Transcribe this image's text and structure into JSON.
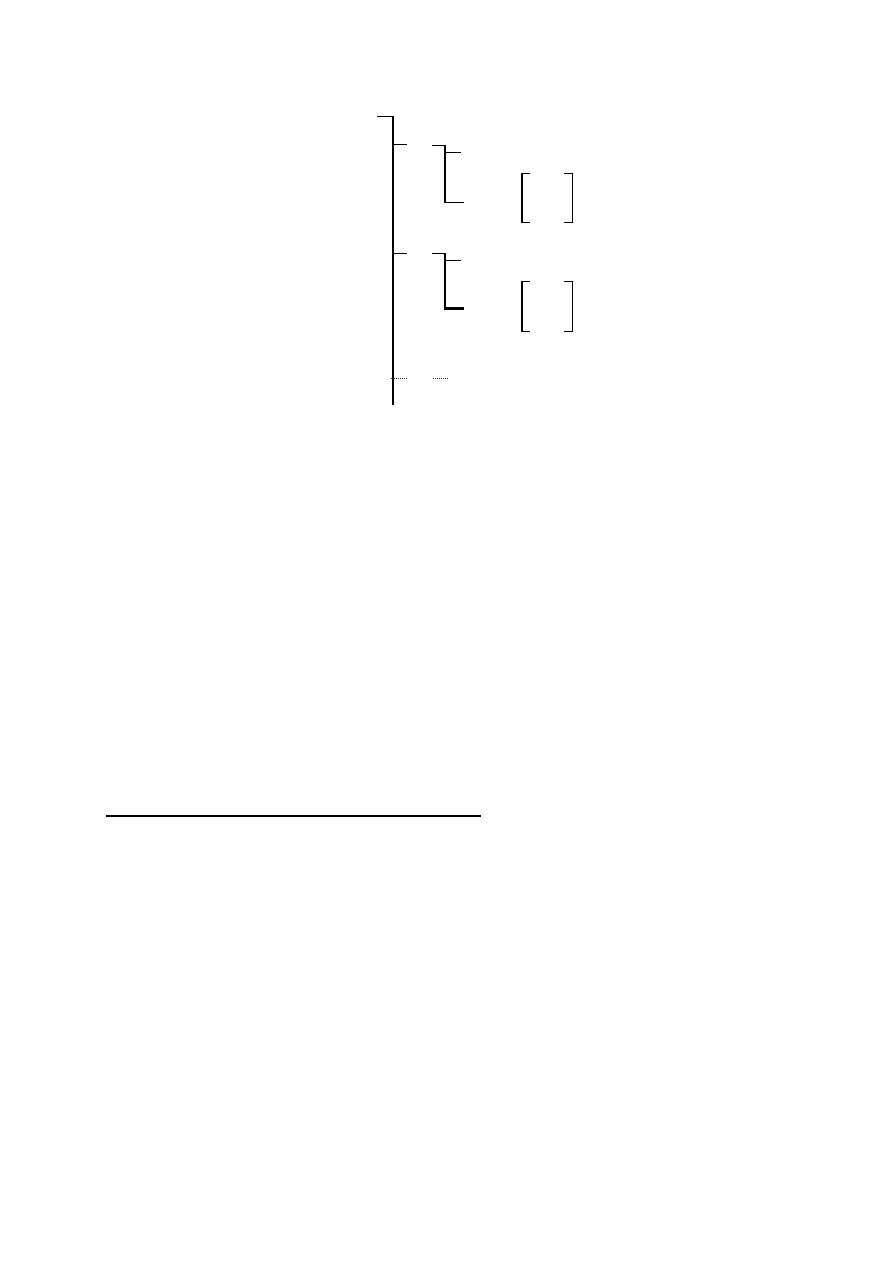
{
  "page": {
    "background": "#ffffff",
    "ink_color": "#000000",
    "dotted_color": "#333333"
  },
  "figure": {
    "segments": [
      {
        "name": "tree-root-top-bar",
        "group": "tree",
        "x": 377,
        "y": 116,
        "w": 16,
        "h": 1,
        "style": "solid"
      },
      {
        "name": "tree-trunk-vertical",
        "group": "tree",
        "x": 392,
        "y": 116,
        "w": 1.5,
        "h": 289,
        "style": "solid"
      },
      {
        "name": "tree-branch1-tick",
        "group": "tree",
        "x": 392,
        "y": 144,
        "w": 15,
        "h": 1,
        "style": "solid"
      },
      {
        "name": "tree-branch2-tick",
        "group": "tree",
        "x": 392,
        "y": 253,
        "w": 15,
        "h": 1,
        "style": "solid"
      },
      {
        "name": "tree-branch3-dotted-tick",
        "group": "tree",
        "x": 391,
        "y": 378,
        "w": 16,
        "h": 1,
        "style": "dotted"
      },
      {
        "name": "subtree-a-top-bar",
        "group": "subtree-a",
        "x": 432,
        "y": 145,
        "w": 14,
        "h": 1,
        "style": "solid"
      },
      {
        "name": "subtree-a-vertical",
        "group": "subtree-a",
        "x": 444,
        "y": 145,
        "w": 1.5,
        "h": 58,
        "style": "solid"
      },
      {
        "name": "subtree-a-branch-tick",
        "group": "subtree-a",
        "x": 444,
        "y": 152,
        "w": 17,
        "h": 1,
        "style": "solid"
      },
      {
        "name": "subtree-a-bottom-bar",
        "group": "subtree-a",
        "x": 444,
        "y": 202,
        "w": 20,
        "h": 1,
        "style": "solid"
      },
      {
        "name": "subtree-b-top-bar",
        "group": "subtree-b",
        "x": 432,
        "y": 253,
        "w": 14,
        "h": 1,
        "style": "solid"
      },
      {
        "name": "subtree-b-vertical",
        "group": "subtree-b",
        "x": 444,
        "y": 253,
        "w": 1.5,
        "h": 56,
        "style": "solid"
      },
      {
        "name": "subtree-b-branch-tick",
        "group": "subtree-b",
        "x": 444,
        "y": 260,
        "w": 17,
        "h": 1,
        "style": "solid"
      },
      {
        "name": "subtree-b-bottom-bar-bold",
        "group": "subtree-b",
        "x": 444,
        "y": 307,
        "w": 20,
        "h": 3,
        "style": "solid"
      },
      {
        "name": "subtree-continuation-dotted-dash",
        "group": "tree",
        "x": 433,
        "y": 378,
        "w": 15,
        "h": 1,
        "style": "dotted"
      },
      {
        "name": "matrix1-left-bracket-stem",
        "group": "matrix-1",
        "x": 521,
        "y": 173,
        "w": 1.5,
        "h": 50,
        "style": "solid"
      },
      {
        "name": "matrix1-left-bracket-top-serif",
        "group": "matrix-1",
        "x": 521,
        "y": 173,
        "w": 9,
        "h": 1,
        "style": "solid"
      },
      {
        "name": "matrix1-left-bracket-bottom-serif",
        "group": "matrix-1",
        "x": 521,
        "y": 222,
        "w": 9,
        "h": 1,
        "style": "solid"
      },
      {
        "name": "matrix1-right-bracket-stem",
        "group": "matrix-1",
        "x": 571.5,
        "y": 173,
        "w": 1.5,
        "h": 50,
        "style": "solid"
      },
      {
        "name": "matrix1-right-bracket-top-serif",
        "group": "matrix-1",
        "x": 564,
        "y": 173,
        "w": 9,
        "h": 1,
        "style": "solid"
      },
      {
        "name": "matrix1-right-bracket-bottom-serif",
        "group": "matrix-1",
        "x": 564,
        "y": 222,
        "w": 9,
        "h": 1,
        "style": "solid"
      },
      {
        "name": "matrix2-left-bracket-stem",
        "group": "matrix-2",
        "x": 521,
        "y": 281,
        "w": 1.5,
        "h": 51,
        "style": "solid"
      },
      {
        "name": "matrix2-left-bracket-top-serif",
        "group": "matrix-2",
        "x": 521,
        "y": 281,
        "w": 9,
        "h": 1,
        "style": "solid"
      },
      {
        "name": "matrix2-left-bracket-bottom-serif",
        "group": "matrix-2",
        "x": 521,
        "y": 331,
        "w": 9,
        "h": 1,
        "style": "solid"
      },
      {
        "name": "matrix2-right-bracket-stem",
        "group": "matrix-2",
        "x": 571.5,
        "y": 281,
        "w": 1.5,
        "h": 51,
        "style": "solid"
      },
      {
        "name": "matrix2-right-bracket-top-serif",
        "group": "matrix-2",
        "x": 564,
        "y": 281,
        "w": 9,
        "h": 1,
        "style": "solid"
      },
      {
        "name": "matrix2-right-bracket-bottom-serif",
        "group": "matrix-2",
        "x": 564,
        "y": 331,
        "w": 9,
        "h": 1,
        "style": "solid"
      },
      {
        "name": "footnote-rule",
        "group": "footnote",
        "x": 106,
        "y": 815,
        "w": 375,
        "h": 1.5,
        "style": "solid"
      }
    ]
  }
}
